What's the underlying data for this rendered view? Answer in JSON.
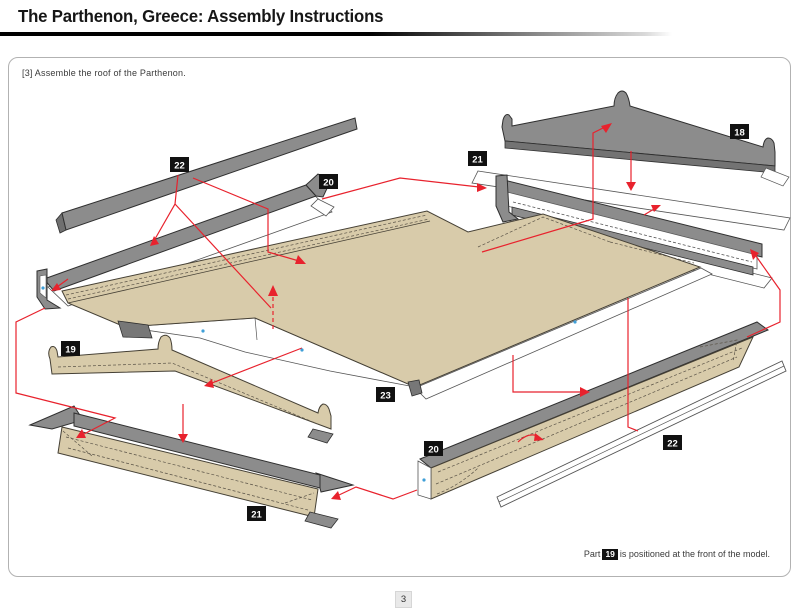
{
  "header": {
    "title": "The Parthenon, Greece: Assembly Instructions"
  },
  "instruction": {
    "text": "[3] Assemble the roof of the Parthenon."
  },
  "diagram": {
    "labels": {
      "strip_top": "22",
      "gutter_left": "20",
      "channel_top": "21",
      "pediment_back": "18",
      "pediment_front": "19",
      "roof": "23",
      "beam_bottom": "20",
      "gutter_bottom": "21",
      "strip_bottom": "22"
    }
  },
  "footer": {
    "part_prefix": "Part",
    "part_ref": "19",
    "note": "is positioned at the front of the model."
  },
  "page": {
    "number": "3"
  },
  "colors": {
    "accent_red": "#e8222d",
    "card_tan": "#d8cbaa",
    "card_gray": "#8c8c8c",
    "card_gray_dark": "#737373",
    "label_bg": "#111111",
    "label_text": "#ffffff",
    "mark_blue": "#3f9fd8"
  }
}
